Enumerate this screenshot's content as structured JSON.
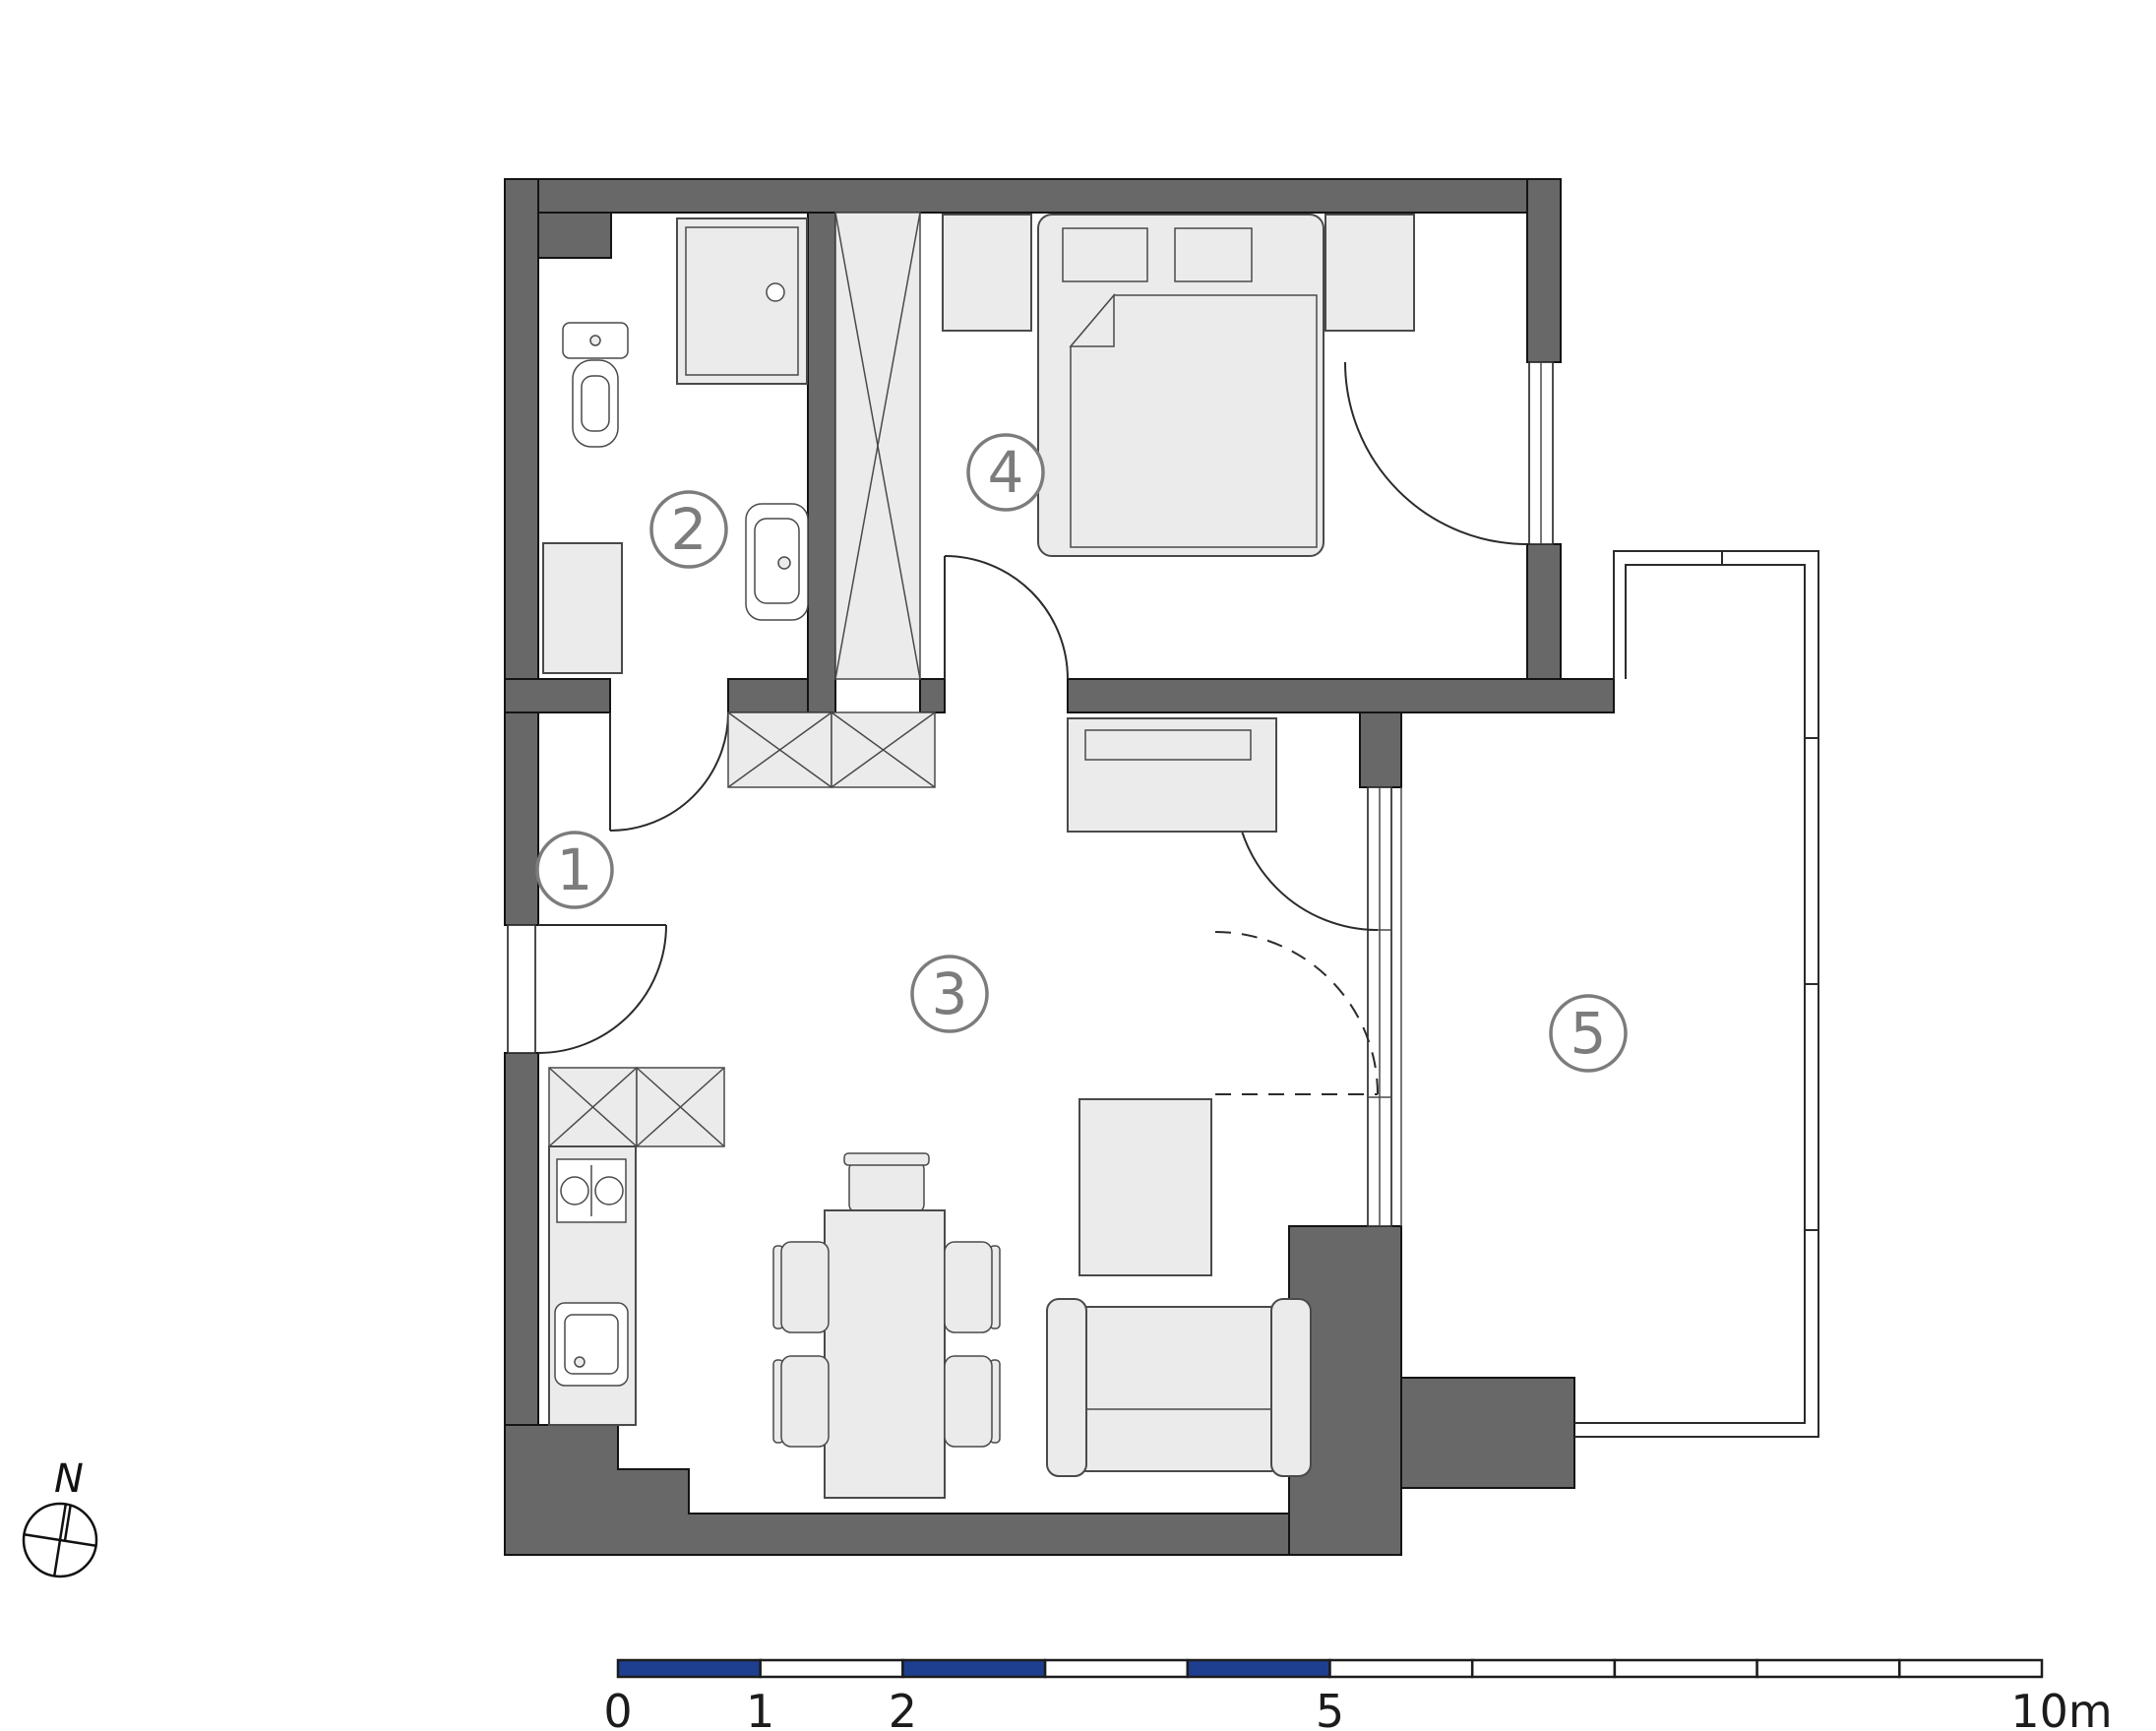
{
  "plan": {
    "type": "apartment-floor-plan",
    "rooms": [
      {
        "number": "1",
        "name": "entrance-hall"
      },
      {
        "number": "2",
        "name": "bathroom"
      },
      {
        "number": "3",
        "name": "living-room-kitchen"
      },
      {
        "number": "4",
        "name": "bedroom"
      },
      {
        "number": "5",
        "name": "balcony"
      }
    ],
    "furniture": {
      "bathroom": [
        "shower",
        "toilet",
        "washbasin",
        "washing-machine"
      ],
      "hallway": [
        "wardrobe-tall",
        "cabinet-hatched-left",
        "cabinet-hatched-right"
      ],
      "kitchen": [
        "upper-cabinets-hatched",
        "counter",
        "hob",
        "kitchen-sink"
      ],
      "living_room": [
        "sideboard",
        "dining-table",
        "head-chair",
        "chairs",
        "coffee-table",
        "sofa"
      ],
      "bedroom": [
        "nightstand-left",
        "double-bed",
        "pillows",
        "blanket",
        "nightstand-right"
      ],
      "doors": [
        "entrance-door",
        "bathroom-door",
        "bedroom-door",
        "bedroom-balcony-door",
        "living-balcony-door-solid",
        "living-balcony-door-dashed"
      ]
    }
  },
  "compass": {
    "label": "N"
  },
  "scale_bar": {
    "unit": "m",
    "meters_total": 10,
    "labels": [
      {
        "text": "0",
        "m": 0
      },
      {
        "text": "1",
        "m": 1
      },
      {
        "text": "2",
        "m": 2
      },
      {
        "text": "5",
        "m": 5
      },
      {
        "text": "10m",
        "m": 10
      }
    ],
    "segment_boundaries_m": [
      0,
      1,
      2,
      3,
      4,
      5,
      6,
      7,
      8,
      9,
      10
    ],
    "blue_segments_m": [
      [
        0,
        1
      ],
      [
        2,
        3
      ],
      [
        4,
        5
      ]
    ]
  },
  "colors": {
    "wall": "#686868",
    "outline": "#141414",
    "furniture_fill": "#ebebeb",
    "furniture_stroke": "#4a4a4a",
    "room_label": "#7c7c7c",
    "scale_blue": "#1e3f8f",
    "background": "#ffffff"
  }
}
